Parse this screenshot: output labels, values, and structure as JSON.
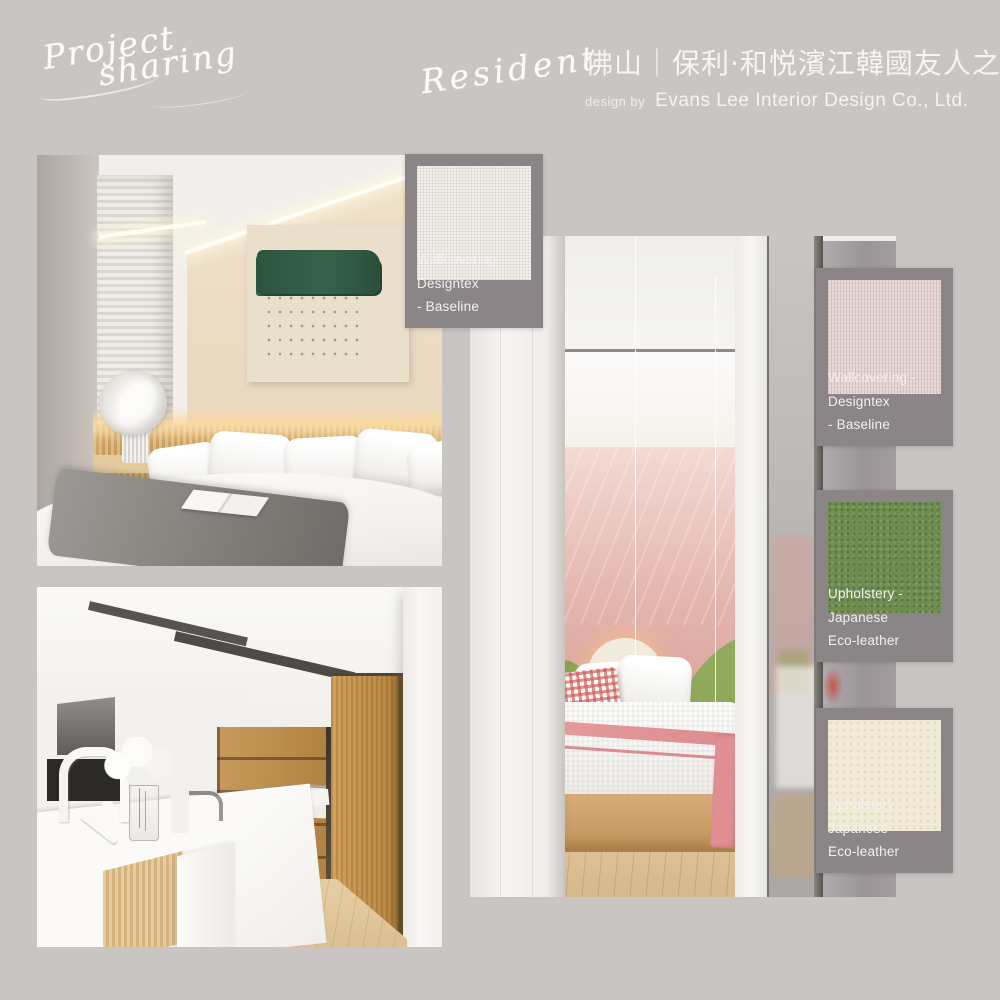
{
  "page": {
    "background_color": "#C9C5C3"
  },
  "colors": {
    "card_background": "#8B8587",
    "text_white": "#F5F4F3",
    "accent_green": "#6F8D51",
    "accent_pink_wall": "#E3B4AC"
  },
  "header": {
    "project_script": {
      "line1": "Project",
      "line2": "sharing"
    },
    "resident_script": "Resident",
    "title_cn": "佛山｜保利·和悦濱江韓國友人之家",
    "design_by_label": "design by",
    "designer_name": "Evans Lee Interior Design Co., Ltd."
  },
  "swatches": [
    {
      "id": "wallcovering-baseline-white",
      "label_line1": "Wallcovering - Designtex",
      "label_line2": "- Baseline",
      "color": "#F2F1EC"
    },
    {
      "id": "wallcovering-baseline-pink",
      "label_line1": "Wallcovering - Designtex",
      "label_line2": "- Baseline",
      "color": "#E4D5D2"
    },
    {
      "id": "upholstery-eco-leather-green",
      "label_line1": "Upholstery - Japanese",
      "label_line2": "Eco-leather",
      "color": "#6F8D51"
    },
    {
      "id": "upholstery-eco-leather-cream",
      "label_line1": "Upholstery - Japanese",
      "label_line2": "Eco-leather",
      "color": "#F1EAD4"
    }
  ]
}
